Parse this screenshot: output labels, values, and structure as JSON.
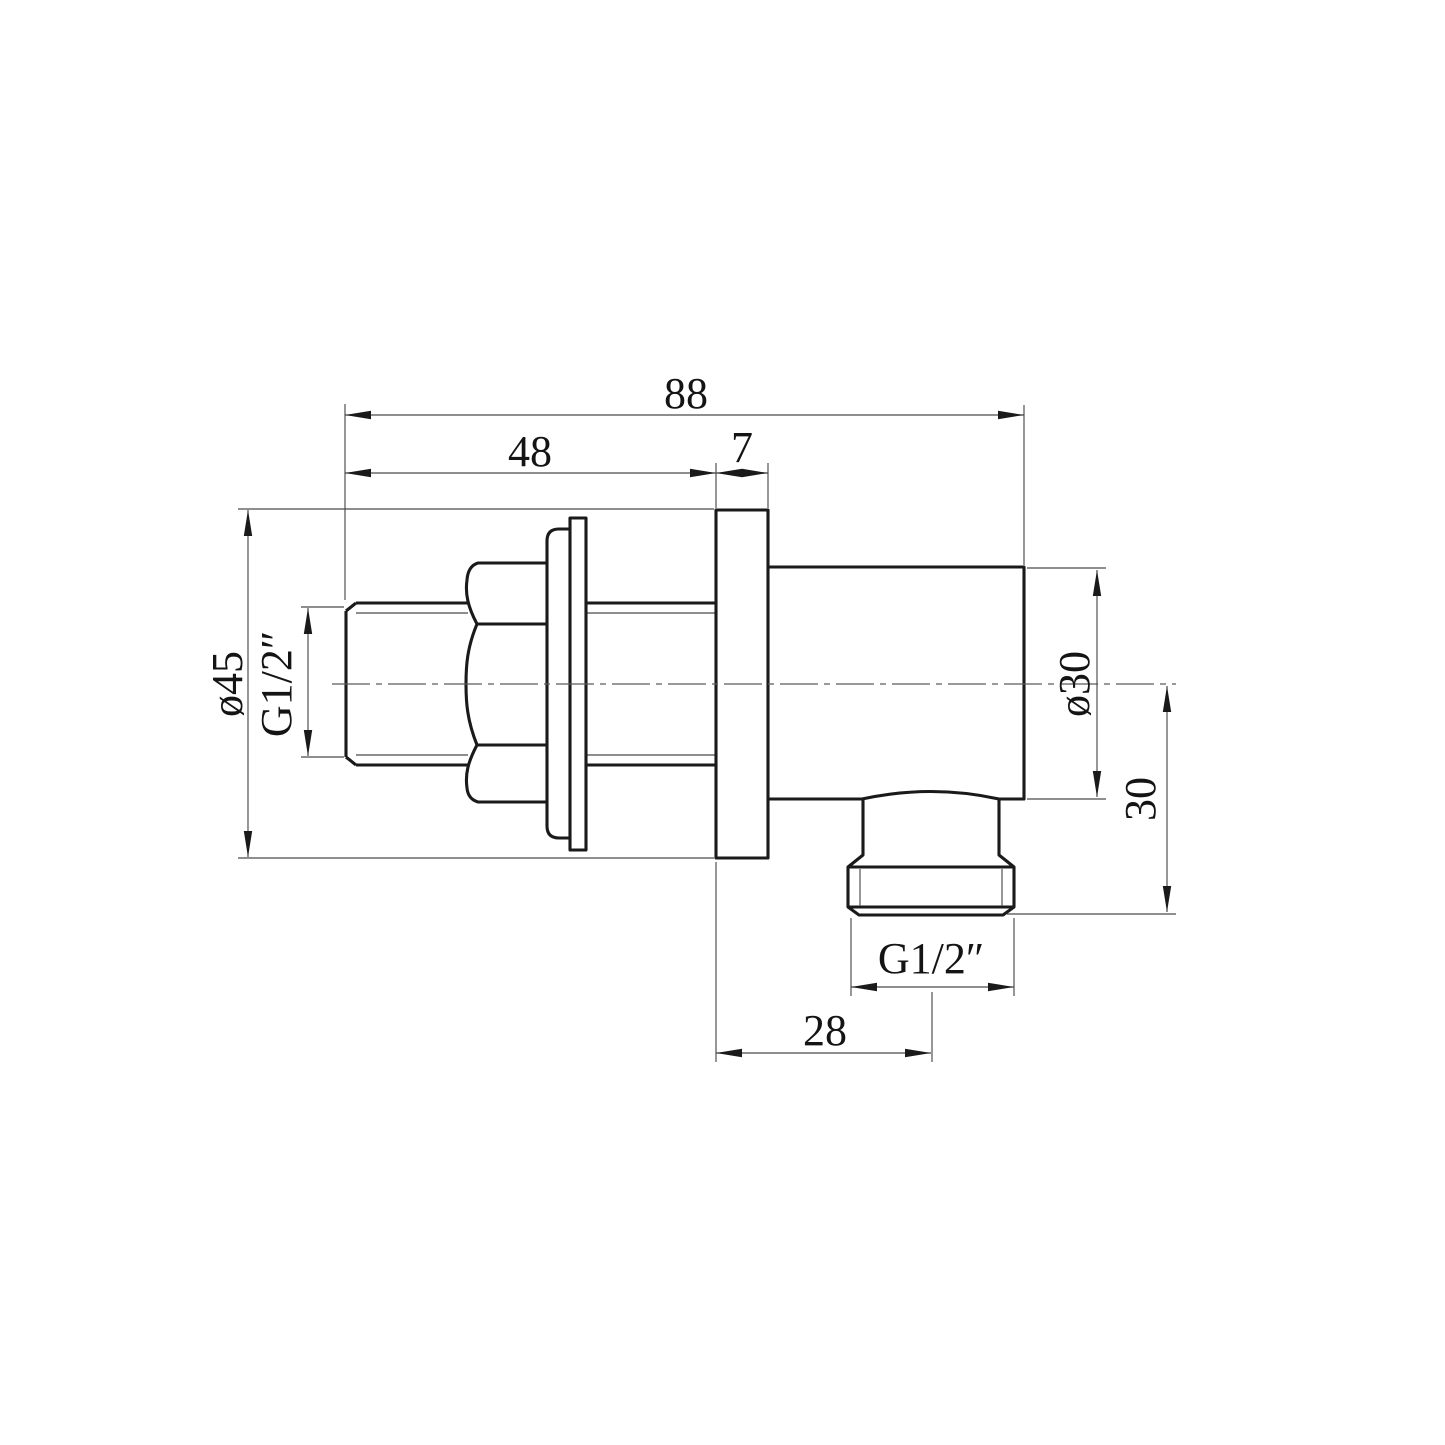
{
  "drawing": {
    "background": "#ffffff",
    "line_color": "#1a1a1a",
    "thin_line_color": "#4a4a4a",
    "dims": {
      "overall_length": "88",
      "inlet_length": "48",
      "plate_thickness": "7",
      "flange_diameter": "ø45",
      "inlet_thread": "G1/2″",
      "body_diameter": "ø30",
      "outlet_height": "30",
      "outlet_thread": "G1/2″",
      "outlet_offset": "28"
    }
  }
}
